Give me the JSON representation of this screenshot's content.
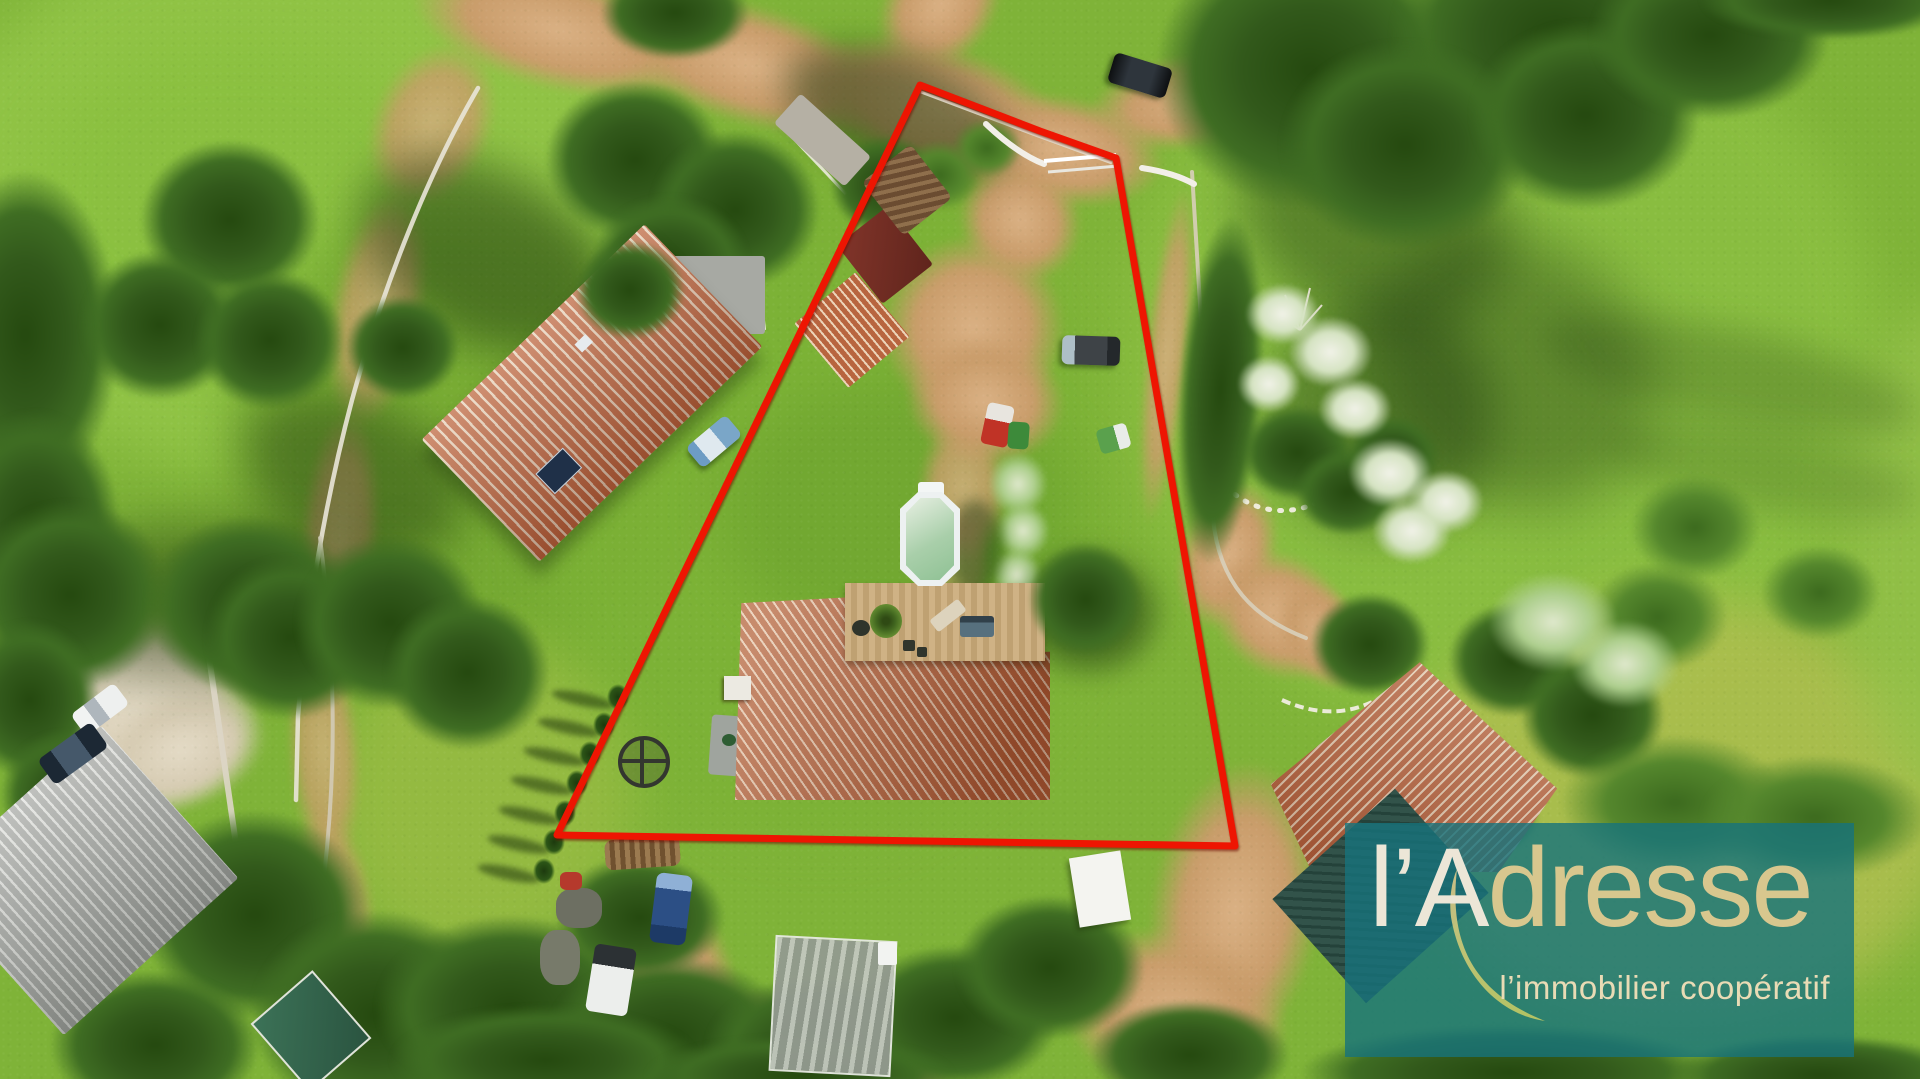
{
  "image": {
    "type": "aerial drone photograph",
    "subject": "building plot outlined in red with a villa, above-ground pool, wooden deck, dirt driveway, neighbouring houses, meadows and trees",
    "width": 1920,
    "height": 1079
  },
  "boundary": {
    "color": "#ee1502",
    "stroke_width": 7,
    "points": [
      [
        920,
        85
      ],
      [
        1040,
        131
      ],
      [
        1116,
        158
      ],
      [
        1235,
        846
      ],
      [
        557,
        835
      ]
    ]
  },
  "watermark": {
    "brand_prefix": "l’A",
    "brand_rest": "dresse",
    "tagline": "l’immobilier coopératif",
    "panel_color": "rgba(23,115,124,0.80)",
    "brand_prefix_color": "#ece6d7",
    "brand_rest_color": "#d8c78e",
    "tagline_color": "#e9dbb5",
    "swoosh_colors": [
      "#dcc88b",
      "#c2ca62"
    ]
  },
  "scene": {
    "palette": {
      "grass": "#7fb338",
      "grass_bright": "#92c547",
      "tree_dark": "#32591b",
      "dirt": "#c99c6a",
      "gravel": "#d6cbb2",
      "roof_terracotta": "#b65f3a",
      "roof_grey": "#a9aba7",
      "deck_wood": "#c7ab7c",
      "pool_rim": "#edf1f1",
      "pool_water": "#a9cfaa",
      "wall_white": "#e9e5d8"
    },
    "objects": [
      "main villa with terracotta hip roof",
      "wooden deck with plant, table, lounge chair and grill",
      "above-ground oval pool with white rim",
      "dirt driveway with white entrance gate",
      "neighbour house north-west with solar panel",
      "neighbour house south-east",
      "neighbour house south-west with grey roof",
      "garden bed with white flowering shrubs and stone border",
      "row of cypress trees along the boundary",
      "parked cars and utility vehicles",
      "meadows, hedges and large trees"
    ]
  }
}
